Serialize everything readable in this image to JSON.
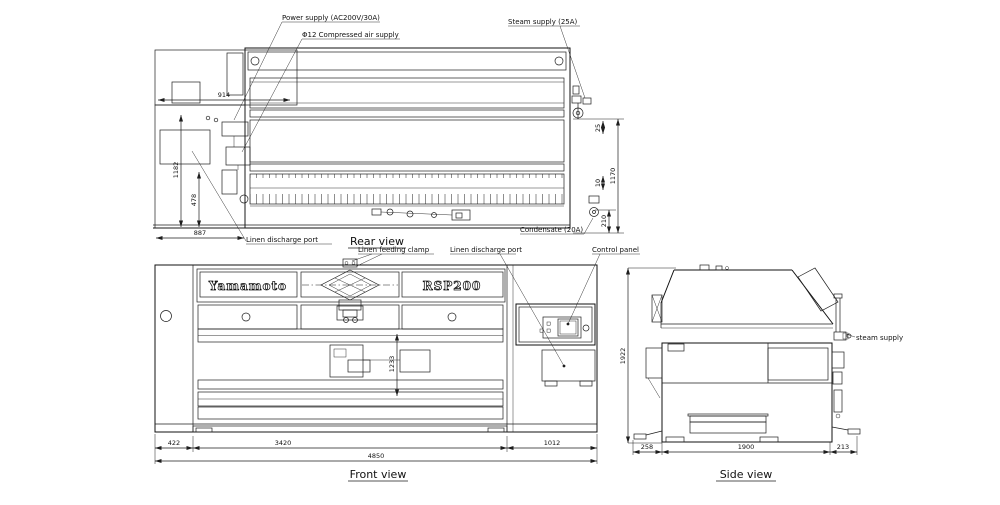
{
  "page": {
    "background": "#ffffff",
    "line_color": "#1e1e1e"
  },
  "views": {
    "rear": {
      "title": "Rear view"
    },
    "front": {
      "title": "Front view"
    },
    "side": {
      "title": "Side view"
    }
  },
  "branding": {
    "maker": "Yamamoto",
    "model": "RSP200"
  },
  "labels": {
    "power_supply": "Power supply (AC200V/30A)",
    "compressed_air": "Φ12 Compressed air supply",
    "steam_supply": "Steam supply (25A)",
    "condensate": "Condensate (20A)",
    "linen_discharge_rear": "Linen discharge port",
    "linen_feeding_clamp": "Linen feeding clamp",
    "linen_discharge_front": "Linen discharge port",
    "control_panel": "Control panel",
    "steam_supply_side": "steam supply"
  },
  "dimensions": {
    "rear": {
      "top_width": "914",
      "left_height": "1182",
      "left_lower_height": "478",
      "bottom_width": "887",
      "steam_offset": "25",
      "pipe_offset": "10",
      "right_height": "1170",
      "condensate_height": "210"
    },
    "front": {
      "left_width": "422",
      "body_width": "3420",
      "right_width": "1012",
      "total_width": "4850",
      "roller_height": "1233"
    },
    "side": {
      "front_depth": "258",
      "body_depth": "1900",
      "rear_depth": "213",
      "height": "1922"
    }
  }
}
